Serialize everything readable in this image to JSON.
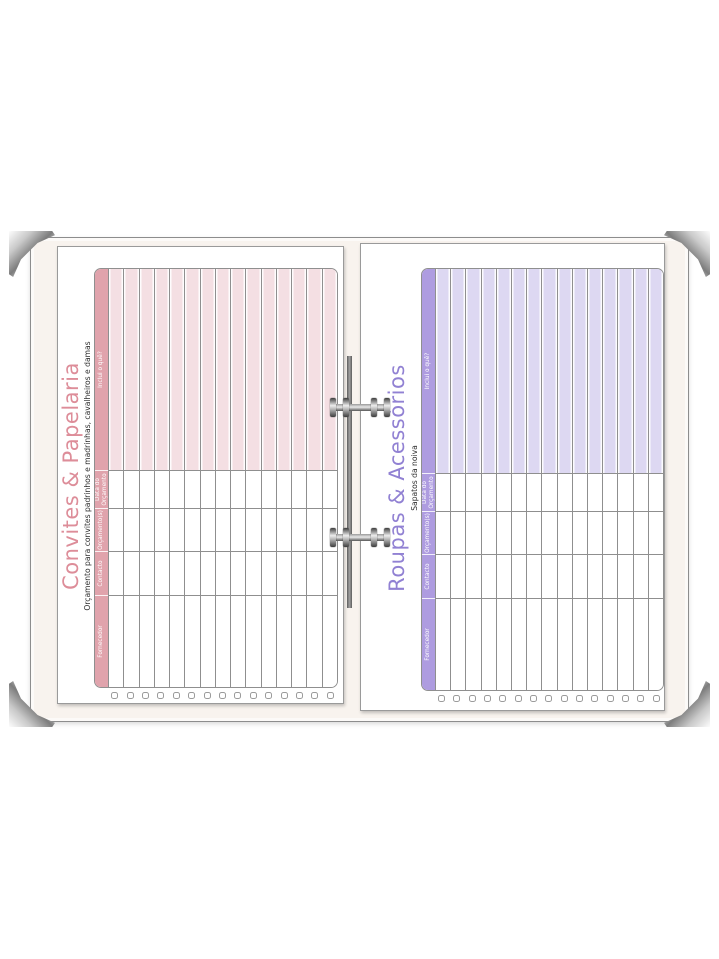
{
  "binder": {
    "cover_color": "#f8f3ee",
    "metal_color": "#b5b5b5",
    "parts": [
      "corner-protector-top-left",
      "corner-protector-top-right",
      "corner-protector-bottom-left",
      "corner-protector-bottom-right",
      "binder-ring-top",
      "binder-ring-bottom",
      "binder-spine-rod"
    ]
  },
  "pages": [
    {
      "id": "left",
      "title": "Convites & Papelaria",
      "subtitle": "Orçamento para convites padrinhos e madrinhas, cavalheiros e damas",
      "colors": {
        "title": "#dd8d99",
        "header_bg": "#e0a3ac",
        "highlight_bg": "#f4dfe3",
        "grid": "#8f8f8f"
      },
      "columns": [
        "Fornecedor",
        "Contacto",
        "Orçamento(s)",
        "Data do\nOrçamento",
        "Inclui o quê?"
      ],
      "highlight_column_index": 4,
      "row_count": 15,
      "checkbox_count": 15
    },
    {
      "id": "right",
      "title": "Roupas & Acessórios",
      "subtitle": "Sapatos da noiva",
      "colors": {
        "title": "#9181d3",
        "header_bg": "#ae9ce0",
        "highlight_bg": "#ddd8f2",
        "grid": "#8f8f8f"
      },
      "columns": [
        "Fornecedor",
        "Contacto",
        "Orçamento(s)",
        "Data do\nOrçamento",
        "Inclui o quê?"
      ],
      "highlight_column_index": 4,
      "row_count": 15,
      "checkbox_count": 15
    }
  ]
}
